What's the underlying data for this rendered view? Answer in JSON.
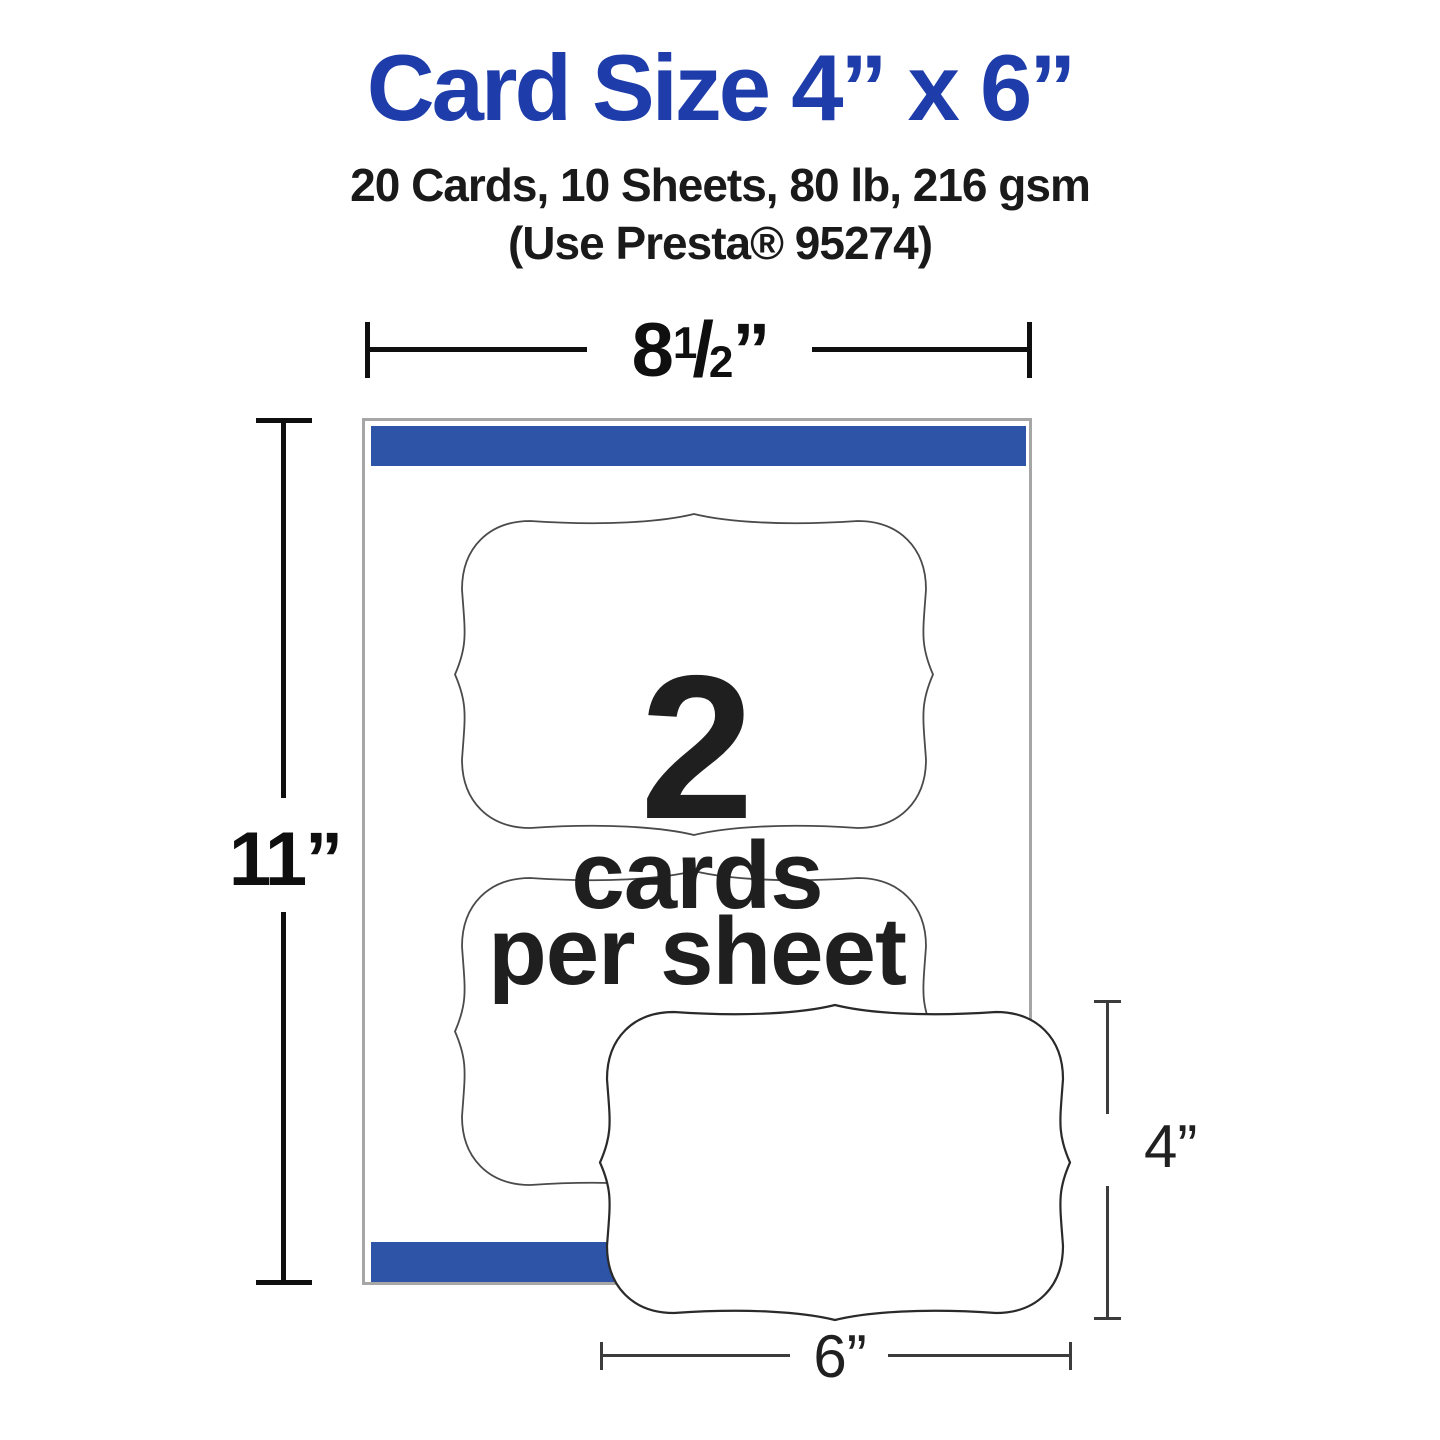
{
  "header": {
    "title": "Card Size 4” x 6”",
    "subtitle_line1": "20 Cards, 10 Sheets, 80 lb, 216 gsm",
    "subtitle_line2": "(Use Presta® 95274)"
  },
  "dimensions": {
    "sheet_width": {
      "whole": "8",
      "numerator": "1",
      "denominator": "2",
      "unit": "”"
    },
    "sheet_height": "11”",
    "card_height": "4”",
    "card_width": "6”"
  },
  "sheet_info": {
    "count_number": "2",
    "count_line1": "cards",
    "count_line2": "per sheet"
  },
  "colors": {
    "title_blue": "#1e3dab",
    "bar_blue": "#2e54a8"
  }
}
